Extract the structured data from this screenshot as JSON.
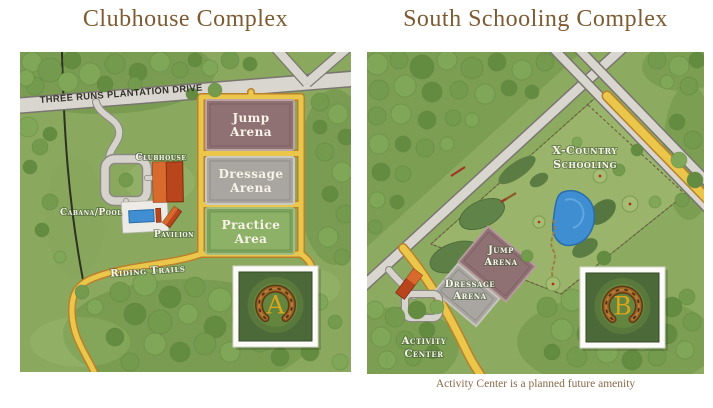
{
  "titles": {
    "left": "Clubhouse Complex",
    "right": "South Schooling Complex"
  },
  "caption": "Activity Center is a planned future amenity",
  "left_map": {
    "road_label": "THREE RUNS PLANTATION DRIVE",
    "badge_letter": "A",
    "labels": {
      "clubhouse": "Clubhouse",
      "cabana_pool": "Cabana/Pool",
      "pavilion": "Pavilion",
      "riding_trails": "Riding Trails",
      "jump_arena": [
        "Jump",
        "Arena"
      ],
      "dressage_arena": [
        "Dressage",
        "Arena"
      ],
      "practice_area": [
        "Practice",
        "Area"
      ]
    }
  },
  "right_map": {
    "badge_letter": "B",
    "labels": {
      "x_country": [
        "X-Country",
        "Schooling"
      ],
      "jump_arena": [
        "Jump",
        "Arena"
      ],
      "dressage_arena": [
        "Dressage",
        "Arena"
      ],
      "activity_center": [
        "Activity",
        "Center"
      ]
    }
  },
  "colors": {
    "title_text": "#7d5c33",
    "caption_text": "#8a6a4a",
    "grass": "#8aa95f",
    "grass_right": "#8cab61",
    "field": "#9ab56b",
    "forest": "#6f9449",
    "road_fill": "#d9d6cf",
    "road_edge": "#7a766f",
    "trail_fill": "#eac64a",
    "trail_edge": "#b9802c",
    "jump_arena": "#8f7073",
    "dressage_arena": "#a9a6a1",
    "practice_area": "#7ca35b",
    "pond": "#3f8ed2",
    "building": "#b8451c",
    "building_roof": "#d96a2d",
    "pool": "#3f8fd2",
    "badge_bg": "#4c6a39",
    "horseshoe": "#9c6527",
    "gold": "#d9a41e"
  }
}
